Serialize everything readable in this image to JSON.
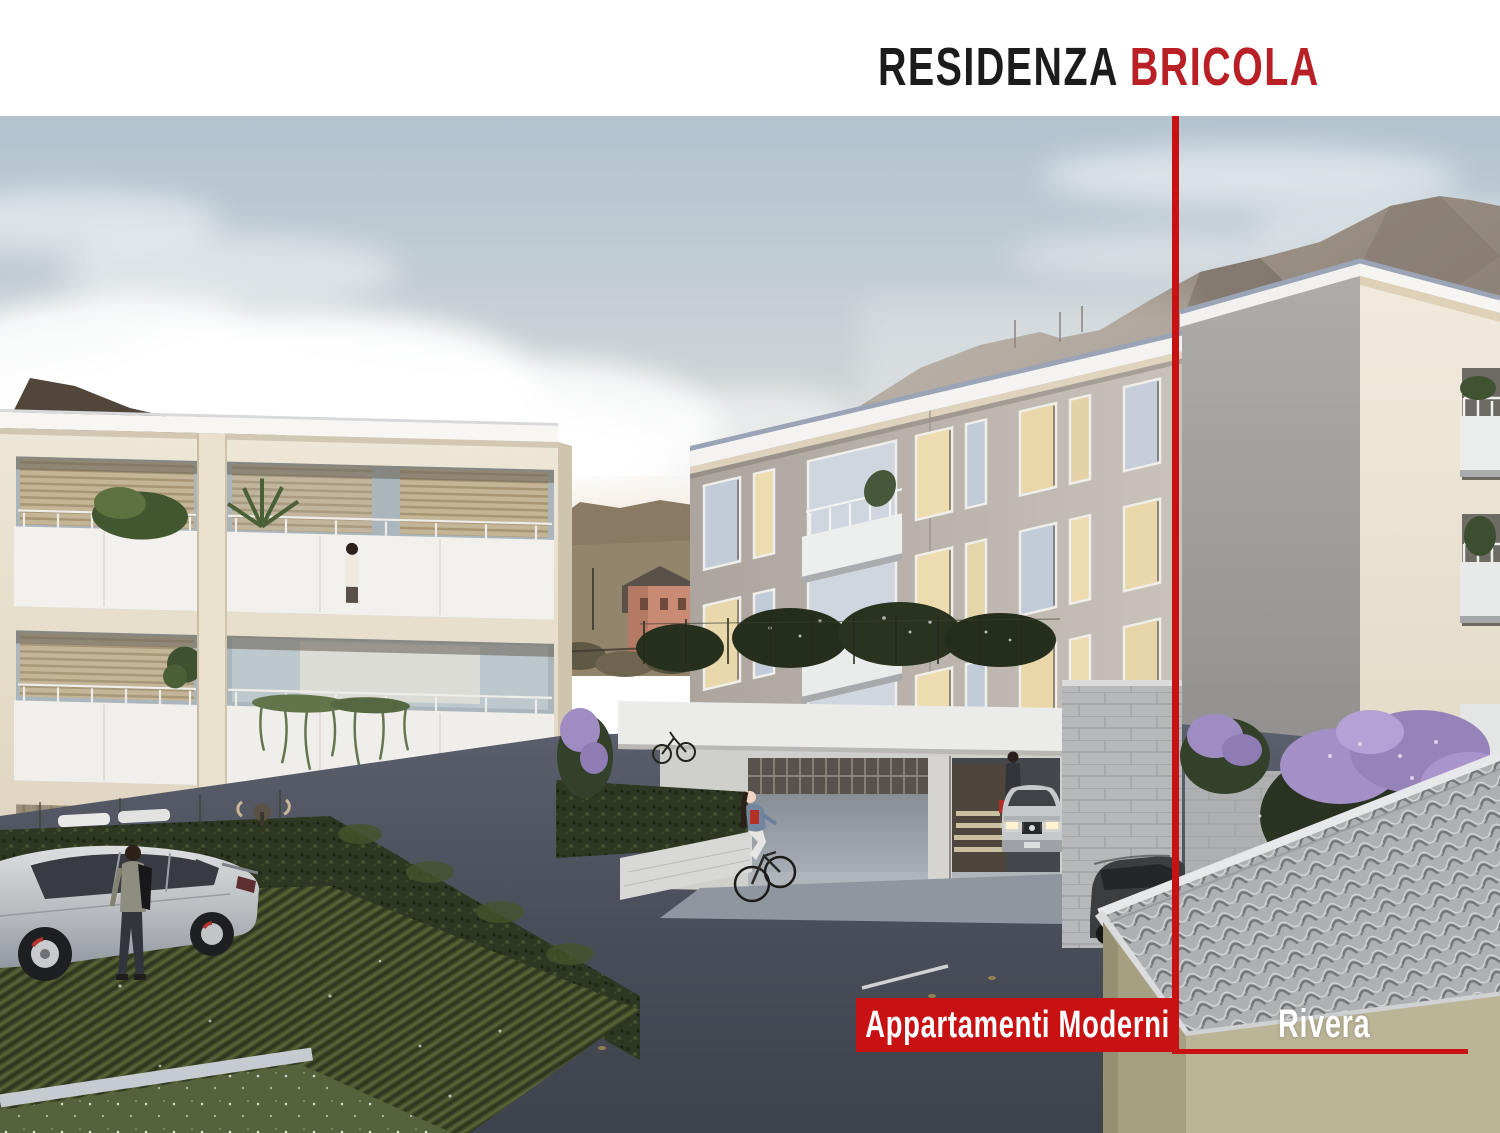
{
  "header": {
    "brand_black": "RESIDENZA",
    "brand_red": "BRICOLA"
  },
  "overlay": {
    "tag_label": "Appartamenti Moderni",
    "location_label": "Rivera"
  },
  "colors": {
    "title_black": "#1c1c1c",
    "title_red": "#b82025",
    "accent_red": "#c81113"
  },
  "scene": {
    "description": "Architectural rendering of modern apartment buildings (Residenza Bricola) with parking, hedges, people and mountains at dusk"
  }
}
